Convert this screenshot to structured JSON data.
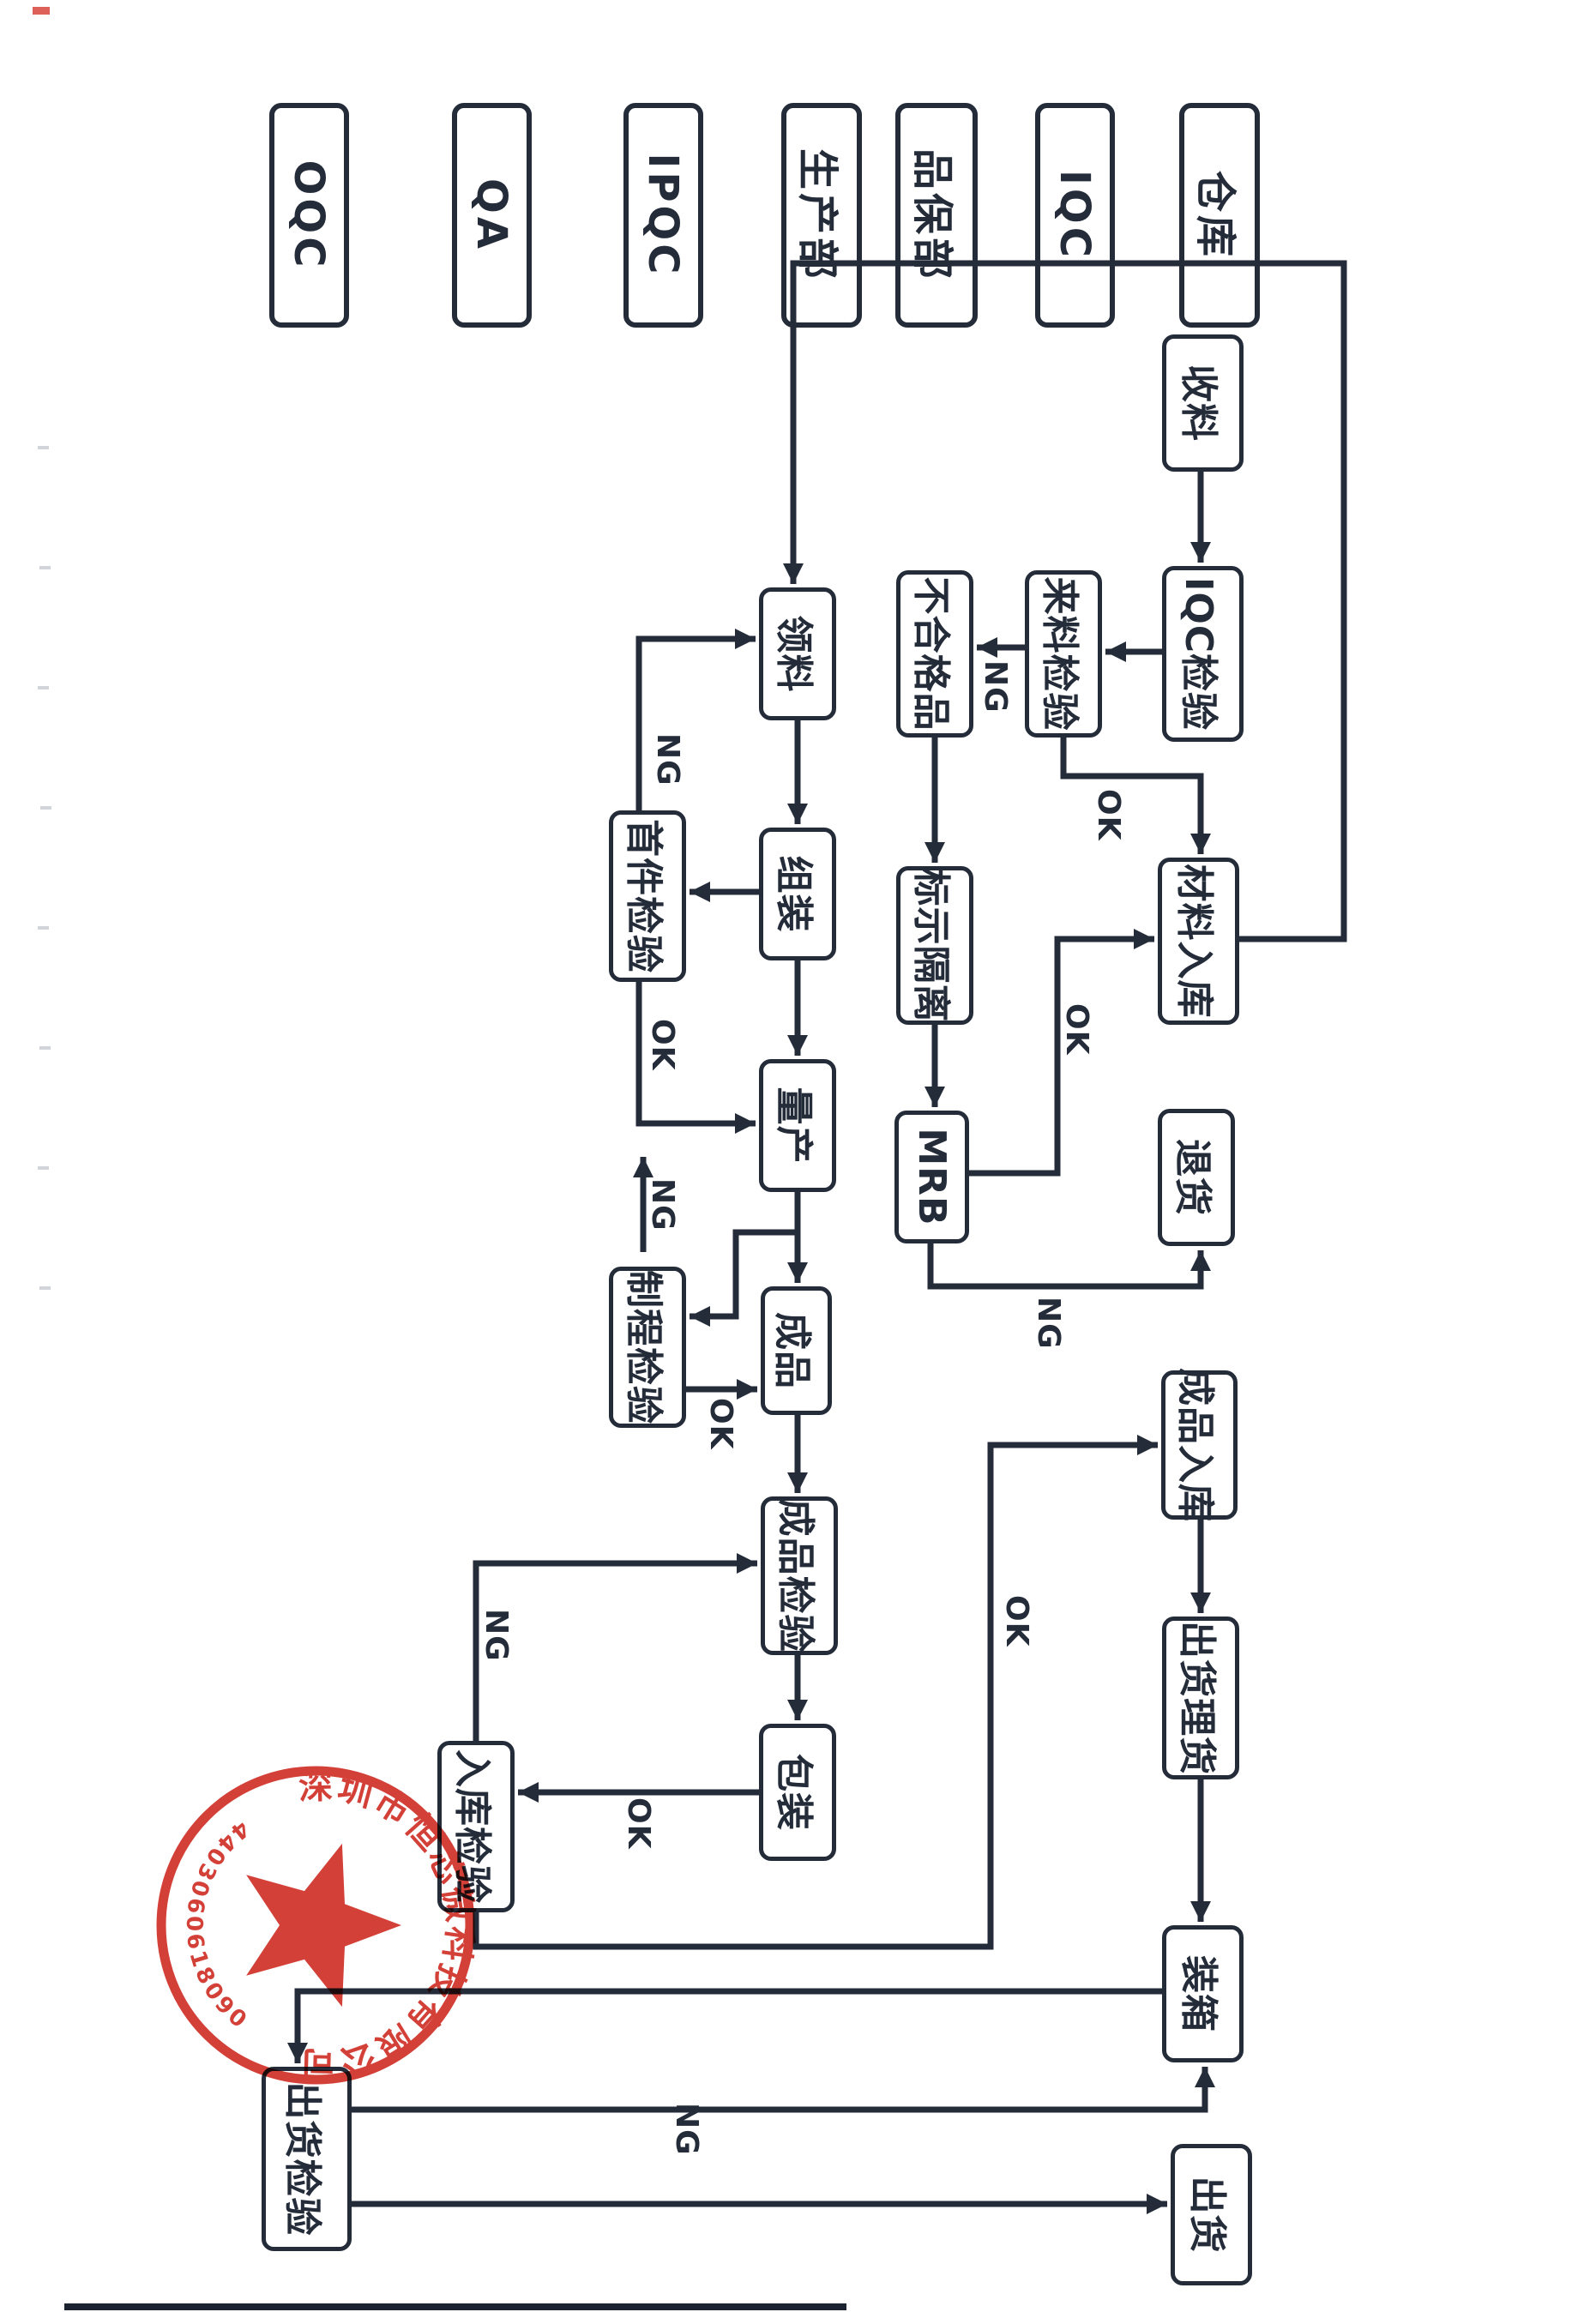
{
  "page": {
    "background": "#ffffff",
    "ink": "#242c3a"
  },
  "lanes": [
    {
      "id": "warehouse",
      "label": "仓库"
    },
    {
      "id": "iqc",
      "label": "IQC"
    },
    {
      "id": "quality-assurance-dept",
      "label": "品保部"
    },
    {
      "id": "production-dept",
      "label": "生产部"
    },
    {
      "id": "ipqc",
      "label": "IPQC"
    },
    {
      "id": "qa",
      "label": "QA"
    },
    {
      "id": "oqc",
      "label": "OQC"
    }
  ],
  "nodes": [
    {
      "id": "receive-material",
      "label": "收料"
    },
    {
      "id": "iqc-inspection",
      "label": "IQC检验"
    },
    {
      "id": "incoming-inspection",
      "label": "来料检验"
    },
    {
      "id": "nonconforming-product",
      "label": "不合格品"
    },
    {
      "id": "mark-and-isolate",
      "label": "标示隔离"
    },
    {
      "id": "mrb",
      "label": "MRB"
    },
    {
      "id": "material-storage",
      "label": "材料入库"
    },
    {
      "id": "return-goods",
      "label": "退货"
    },
    {
      "id": "pick-material",
      "label": "领料"
    },
    {
      "id": "assembly",
      "label": "组装"
    },
    {
      "id": "first-article-inspection",
      "label": "首件检验"
    },
    {
      "id": "mass-production",
      "label": "量产"
    },
    {
      "id": "process-inspection",
      "label": "制程检验"
    },
    {
      "id": "finished-product",
      "label": "成品"
    },
    {
      "id": "finished-product-inspection",
      "label": "成品检验"
    },
    {
      "id": "packaging",
      "label": "包装"
    },
    {
      "id": "storage-inspection",
      "label": "入库检验"
    },
    {
      "id": "finished-goods-storage",
      "label": "成品入库"
    },
    {
      "id": "shipping-tally",
      "label": "出货理货"
    },
    {
      "id": "boxing",
      "label": "装箱"
    },
    {
      "id": "shipping",
      "label": "出货"
    },
    {
      "id": "shipping-inspection",
      "label": "出货检验"
    }
  ],
  "edge_labels": [
    {
      "id": "incoming-inspection-ng",
      "text": "NG"
    },
    {
      "id": "incoming-inspection-ok",
      "text": "OK"
    },
    {
      "id": "mrb-ok",
      "text": "OK"
    },
    {
      "id": "mrb-ng",
      "text": "NG"
    },
    {
      "id": "first-article-ng",
      "text": "NG"
    },
    {
      "id": "first-article-ok",
      "text": "OK"
    },
    {
      "id": "process-inspection-ng",
      "text": "NG"
    },
    {
      "id": "process-inspection-ok",
      "text": "OK"
    },
    {
      "id": "storage-inspection-ng",
      "text": "NG"
    },
    {
      "id": "packaging-ok",
      "text": "OK"
    },
    {
      "id": "storage-inspection-ok",
      "text": "OK"
    },
    {
      "id": "shipping-inspection-ng",
      "text": "NG"
    }
  ],
  "stamp": {
    "company": "深圳市恒芯微科技有限公司",
    "serial": "4403060618090",
    "color": "#cf2f27"
  }
}
